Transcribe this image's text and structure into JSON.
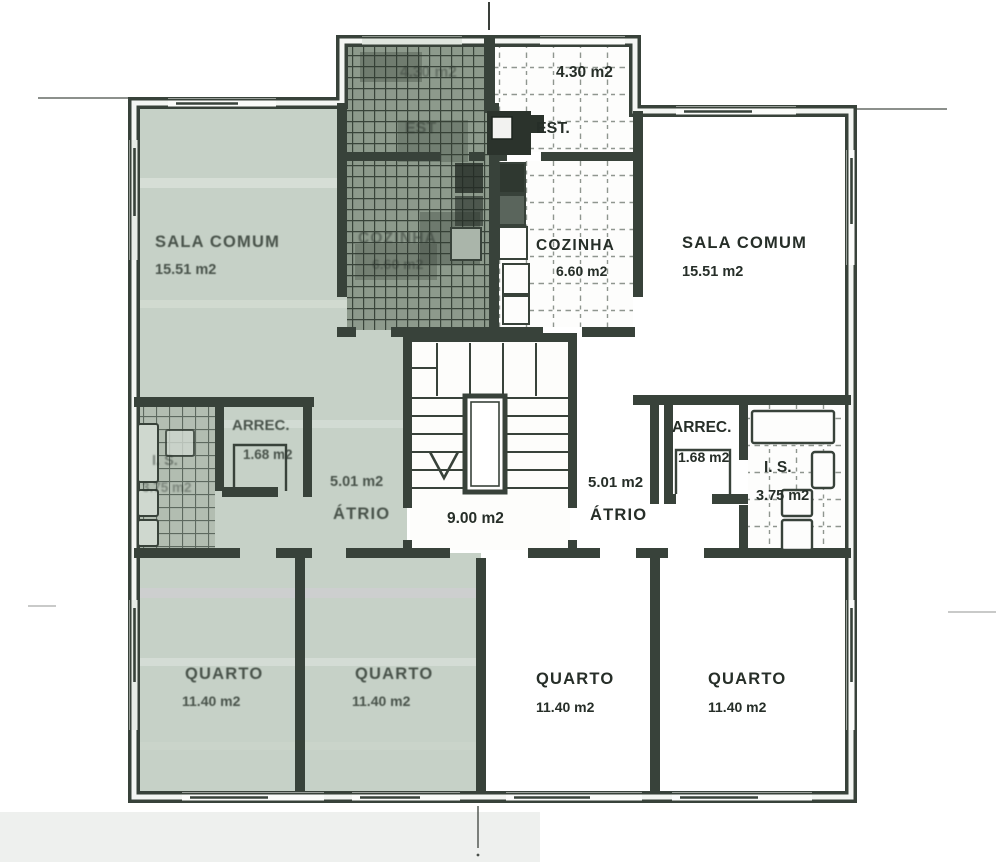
{
  "plan": {
    "type": "architectural-floor-plan",
    "colors": {
      "highlight_unit": "#c6d1c7",
      "wall": "#38423a",
      "paper": "#ffffff",
      "hatch_dark": "#8d9a8c"
    },
    "rooms": {
      "est_left": {
        "name": "EST",
        "area": "4.30 m2"
      },
      "est_right": {
        "name": "EST.",
        "area": "4.30 m2"
      },
      "sala_comum_left": {
        "name": "SALA COMUM",
        "area": "15.51 m2"
      },
      "sala_comum_right": {
        "name": "SALA COMUM",
        "area": "15.51 m2"
      },
      "cozinha_left": {
        "name": "COZINHA",
        "area": "6.60 m2"
      },
      "cozinha_right": {
        "name": "COZINHA",
        "area": "6.60 m2"
      },
      "arrec_left": {
        "name": "ARREC.",
        "area": "1.68 m2"
      },
      "arrec_right": {
        "name": "ARREC.",
        "area": "1.68 m2"
      },
      "is_left": {
        "name": "I. S.",
        "area": "3.75 m2"
      },
      "is_right": {
        "name": "I. S.",
        "area": "3.75 m2"
      },
      "atrio_left": {
        "name": "ÁTRIO",
        "area": "5.01 m2"
      },
      "atrio_right": {
        "name": "ÁTRIO",
        "area": "5.01 m2"
      },
      "stair_hall": {
        "area": "9.00 m2"
      },
      "quarto_1": {
        "name": "QUARTO",
        "area": "11.40 m2"
      },
      "quarto_2": {
        "name": "QUARTO",
        "area": "11.40 m2"
      },
      "quarto_3": {
        "name": "QUARTO",
        "area": "11.40 m2"
      },
      "quarto_4": {
        "name": "QUARTO",
        "area": "11.40 m2"
      }
    }
  }
}
